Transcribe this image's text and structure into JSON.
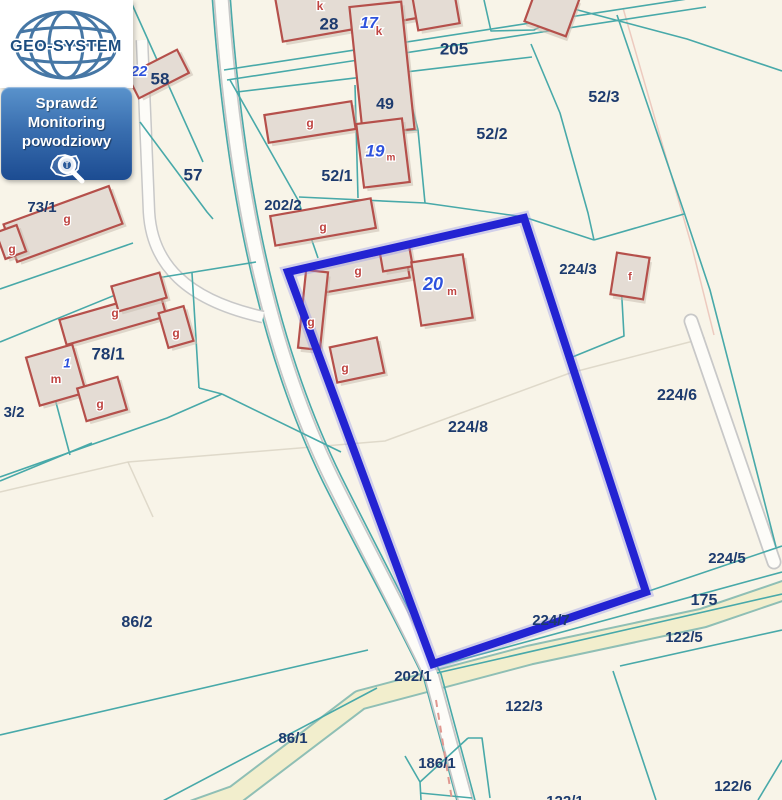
{
  "branding": {
    "logo_text": "GEO-SYSTEM",
    "flood_button": {
      "line1": "Sprawdź",
      "line2": "Monitoring",
      "line3": "powodziowy"
    }
  },
  "map": {
    "selected_parcel": "224/8",
    "parcel_labels": [
      {
        "t": "28",
        "x": 329,
        "y": 25,
        "fs": 17
      },
      {
        "t": "205",
        "x": 454,
        "y": 50,
        "fs": 17
      },
      {
        "t": "49",
        "x": 385,
        "y": 105,
        "fs": 16
      },
      {
        "t": "52/2",
        "x": 492,
        "y": 135,
        "fs": 16
      },
      {
        "t": "52/3",
        "x": 604,
        "y": 98,
        "fs": 16
      },
      {
        "t": "52/1",
        "x": 337,
        "y": 177,
        "fs": 16
      },
      {
        "t": "57",
        "x": 193,
        "y": 176,
        "fs": 17
      },
      {
        "t": "58",
        "x": 160,
        "y": 80,
        "fs": 17
      },
      {
        "t": "202/2",
        "x": 283,
        "y": 206,
        "fs": 15
      },
      {
        "t": "73/1",
        "x": 42,
        "y": 208,
        "fs": 15
      },
      {
        "t": "3/2",
        "x": 14,
        "y": 413,
        "fs": 15
      },
      {
        "t": "78/1",
        "x": 108,
        "y": 355,
        "fs": 17
      },
      {
        "t": "224/3",
        "x": 578,
        "y": 270,
        "fs": 15
      },
      {
        "t": "224/6",
        "x": 677,
        "y": 396,
        "fs": 16
      },
      {
        "t": "224/8",
        "x": 468,
        "y": 428,
        "fs": 16
      },
      {
        "t": "86/2",
        "x": 137,
        "y": 623,
        "fs": 16
      },
      {
        "t": "224/5",
        "x": 727,
        "y": 559,
        "fs": 15
      },
      {
        "t": "175",
        "x": 704,
        "y": 601,
        "fs": 16
      },
      {
        "t": "122/5",
        "x": 684,
        "y": 638,
        "fs": 15
      },
      {
        "t": "224/7",
        "x": 551,
        "y": 621,
        "fs": 15
      },
      {
        "t": "202/1",
        "x": 413,
        "y": 677,
        "fs": 15
      },
      {
        "t": "122/3",
        "x": 524,
        "y": 707,
        "fs": 15
      },
      {
        "t": "86/1",
        "x": 293,
        "y": 739,
        "fs": 15
      },
      {
        "t": "186/1",
        "x": 437,
        "y": 764,
        "fs": 15
      },
      {
        "t": "122/6",
        "x": 733,
        "y": 787,
        "fs": 15
      },
      {
        "t": "122/1",
        "x": 565,
        "y": 802,
        "fs": 15
      }
    ],
    "address_labels": [
      {
        "t": "22",
        "x": 139,
        "y": 72,
        "fs": 15
      },
      {
        "t": "17",
        "x": 369,
        "y": 24,
        "fs": 16
      },
      {
        "t": "19",
        "x": 375,
        "y": 152,
        "fs": 17
      },
      {
        "t": "20",
        "x": 433,
        "y": 285,
        "fs": 18
      },
      {
        "t": "1",
        "x": 67,
        "y": 364,
        "fs": 13
      }
    ],
    "building_letters": [
      {
        "t": "k",
        "x": 320,
        "y": 7
      },
      {
        "t": "k",
        "x": 379,
        "y": 32
      },
      {
        "t": "m",
        "x": 391,
        "y": 158,
        "fs": 10
      },
      {
        "t": "g",
        "x": 310,
        "y": 124
      },
      {
        "t": "g",
        "x": 12,
        "y": 250
      },
      {
        "t": "g",
        "x": 67,
        "y": 220
      },
      {
        "t": "g",
        "x": 115,
        "y": 314
      },
      {
        "t": "g",
        "x": 176,
        "y": 334
      },
      {
        "t": "g",
        "x": 100,
        "y": 405
      },
      {
        "t": "m",
        "x": 56,
        "y": 380
      },
      {
        "t": "g",
        "x": 323,
        "y": 228
      },
      {
        "t": "g",
        "x": 358,
        "y": 272
      },
      {
        "t": "g",
        "x": 311,
        "y": 323
      },
      {
        "t": "g",
        "x": 345,
        "y": 369
      },
      {
        "t": "m",
        "x": 452,
        "y": 292,
        "fs": 11
      },
      {
        "t": "f",
        "x": 630,
        "y": 277,
        "fs": 11
      }
    ],
    "colors": {
      "background": "#f8f4e8",
      "boundary_teal": "#48a9a9",
      "faint_gray": "#d8d2c2",
      "faint_pink": "#eabfb4",
      "selection_blue": "#2323d2",
      "selection_glow": "#8a8aec",
      "building_fill": "#e4dcd4",
      "building_stroke": "#b5504b",
      "building_shadow": "#c9bdb1",
      "road_white": "#fdfcf8",
      "road_casing": "#c8c8c8",
      "road_yellow": "#f2eecd",
      "road_yellow_casing": "#8fbfb5",
      "dashed_pink": "#e09890",
      "label_navy": "#1d3b6e",
      "address_blue": "#2e52dd",
      "letter_red": "#bf4441"
    }
  }
}
